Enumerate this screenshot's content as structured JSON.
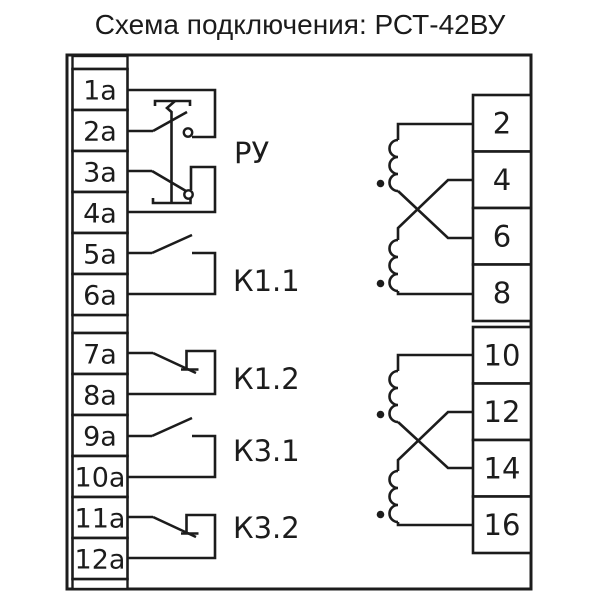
{
  "title": "Схема подключения: РСТ-42ВУ",
  "left_terminals": [
    "1а",
    "2а",
    "3а",
    "4а",
    "5а",
    "6а",
    "7а",
    "8а",
    "9а",
    "10а",
    "11а",
    "12а"
  ],
  "right_terminals": [
    "2",
    "4",
    "6",
    "8",
    "10",
    "12",
    "14",
    "16"
  ],
  "contacts": {
    "manual_switch": "РУ",
    "k1_1": "К1.1",
    "k1_2": "К1.2",
    "k3_1": "К3.1",
    "k3_2": "К3.2"
  },
  "colors": {
    "line": "#1c1c1c",
    "background": "#ffffff"
  }
}
